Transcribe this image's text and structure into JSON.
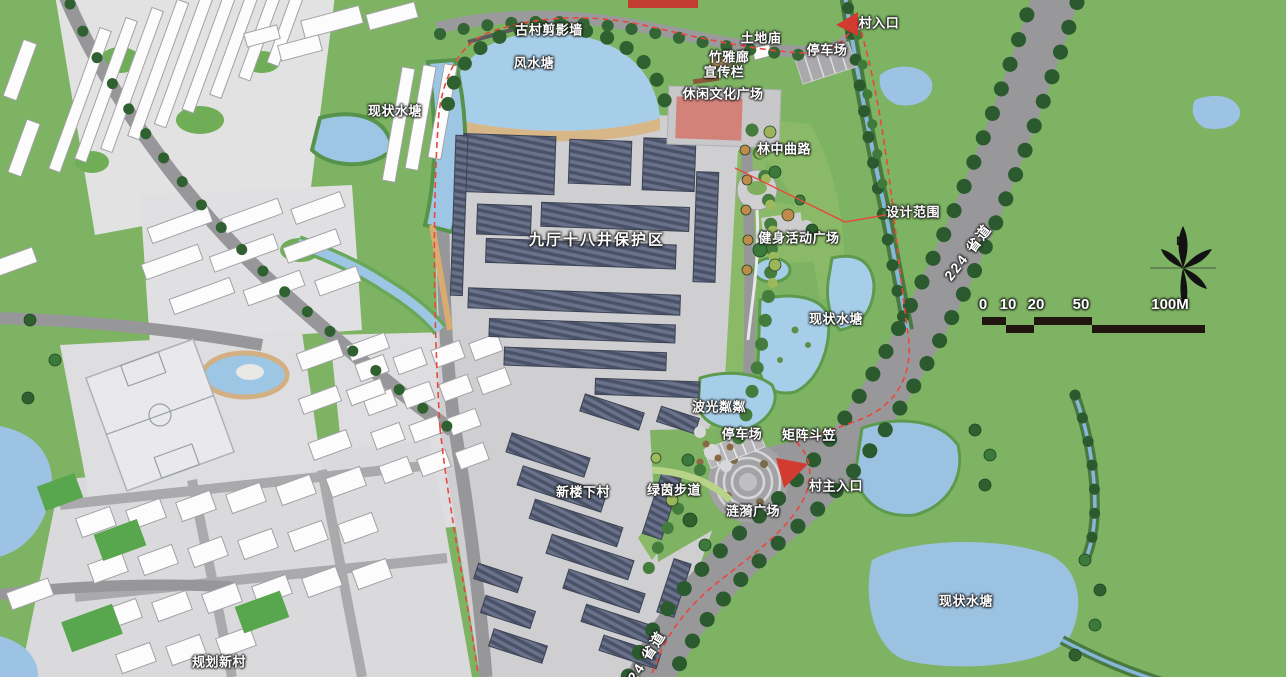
{
  "map": {
    "kind": "village master plan drawing",
    "labels": {
      "gucun_silhouette_wall": "古村剪影墙",
      "fengshui_pond": "风水塘",
      "bamboo_gallery": "竹雅廊",
      "earth_temple": "土地庙",
      "parking_north": "停车场",
      "village_entrance": "村入口",
      "bulletin_board": "宣传栏",
      "leisure_culture_plaza": "休闲文化广场",
      "existing_pond_west": "现状水塘",
      "forest_winding_path": "林中曲路",
      "design_boundary": "设计范围",
      "fitness_plaza": "健身活动广场",
      "protection_zone": "九厅十八井保护区",
      "existing_pond_center": "现状水塘",
      "provincial_road_upper": "224 省道",
      "shimmering_water": "波光粼粼",
      "parking_mid": "停车场",
      "matrix_hats": "矩阵斗笠",
      "village_main_entrance": "村主入口",
      "xinlouxia_village": "新楼下村",
      "green_walkway": "绿茵步道",
      "ripple_plaza": "涟漪广场",
      "existing_pond_southeast": "现状水塘",
      "planned_new_village": "规划新村",
      "provincial_road_lower": "224 省道",
      "north_mark": "N"
    },
    "scale_bar": {
      "ticks": [
        "0",
        "10",
        "20",
        "50",
        "100M"
      ]
    },
    "colors": {
      "field_green": "#7db363",
      "water_blue": "#a0c9e6",
      "road_gray": "#98989b",
      "roof_dark": "#5c6474",
      "boundary_red": "#e8473b",
      "plaza_red": "#d3827a"
    }
  }
}
